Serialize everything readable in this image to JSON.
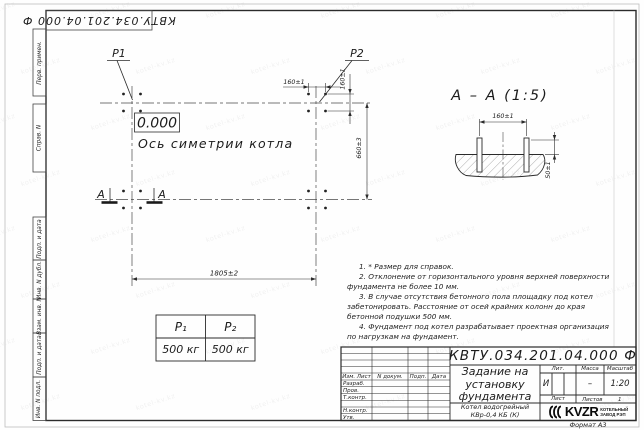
{
  "colors": {
    "line": "#2b2b2b",
    "logo": "#0a0a0a",
    "watermark_tint": "#e8e8e8"
  },
  "watermark": "kotel-kv.kz",
  "margin_stamp": {
    "doc_number_top": "КВТУ.034.201.04.000 Ф",
    "fields": [
      "Перв. примен.",
      "Справ. N",
      "Подп. и дата",
      "Инв. N дубл.",
      "Взам. инв. N",
      "Подп. и дата",
      "Инв. N подл."
    ]
  },
  "plan": {
    "p1_label": "P1",
    "p2_label": "P2",
    "elevation_label": "0.000",
    "axis_label": "Ось симетрии котла",
    "section_letter": "А"
  },
  "dims": {
    "d160": "160±1",
    "d660": "660±3",
    "d1805": "1805±2",
    "d50": "50±1"
  },
  "section_view": {
    "title": "А – А (1:5)"
  },
  "load_table": {
    "headers": [
      "P₁",
      "P₂"
    ],
    "values": [
      "500 кг",
      "500 кг"
    ]
  },
  "notes": [
    "1. * Размер для справок.",
    "2. Отклонение от горизонтального уровня верхней поверхности фундамента не более 10 мм.",
    "3. В случае отсутствия бетонного пола площадку под котел забетонировать. Расстояние от осей крайних колонн до края бетонной подушки 500 мм.",
    "4. Фундамент под котел разрабатывает проектная организация по нагрузкам на фундамент."
  ],
  "title_block": {
    "doc_number": "КВТУ.034.201.04.000 Ф",
    "title_lines": [
      "Задание на",
      "установку",
      "фундамента"
    ],
    "product_lines": [
      "Котел водогрейный",
      "КВр-0,4  КБ  (К)"
    ],
    "rev_headers": [
      "Изм. Лист",
      "N докум.",
      "Подп.",
      "Дата"
    ],
    "sign_rows": [
      "Разраб.",
      "Пров.",
      "Т.контр.",
      "",
      "Н.контр.",
      "Утв."
    ],
    "lit_header": "Лит.",
    "mass_header": "Масса",
    "scale_header": "Масштаб",
    "lit_value": "И",
    "mass_value": "–",
    "scale_value": "1:20",
    "sheet_label": "Лист",
    "sheets_label": "Листов",
    "sheets_value": "1",
    "logo_text": "KVZR",
    "logo_sub": [
      "КОТЕЛЬНЫЙ",
      "ЗАВОД РЭП"
    ],
    "format_label": "Формат А3"
  }
}
